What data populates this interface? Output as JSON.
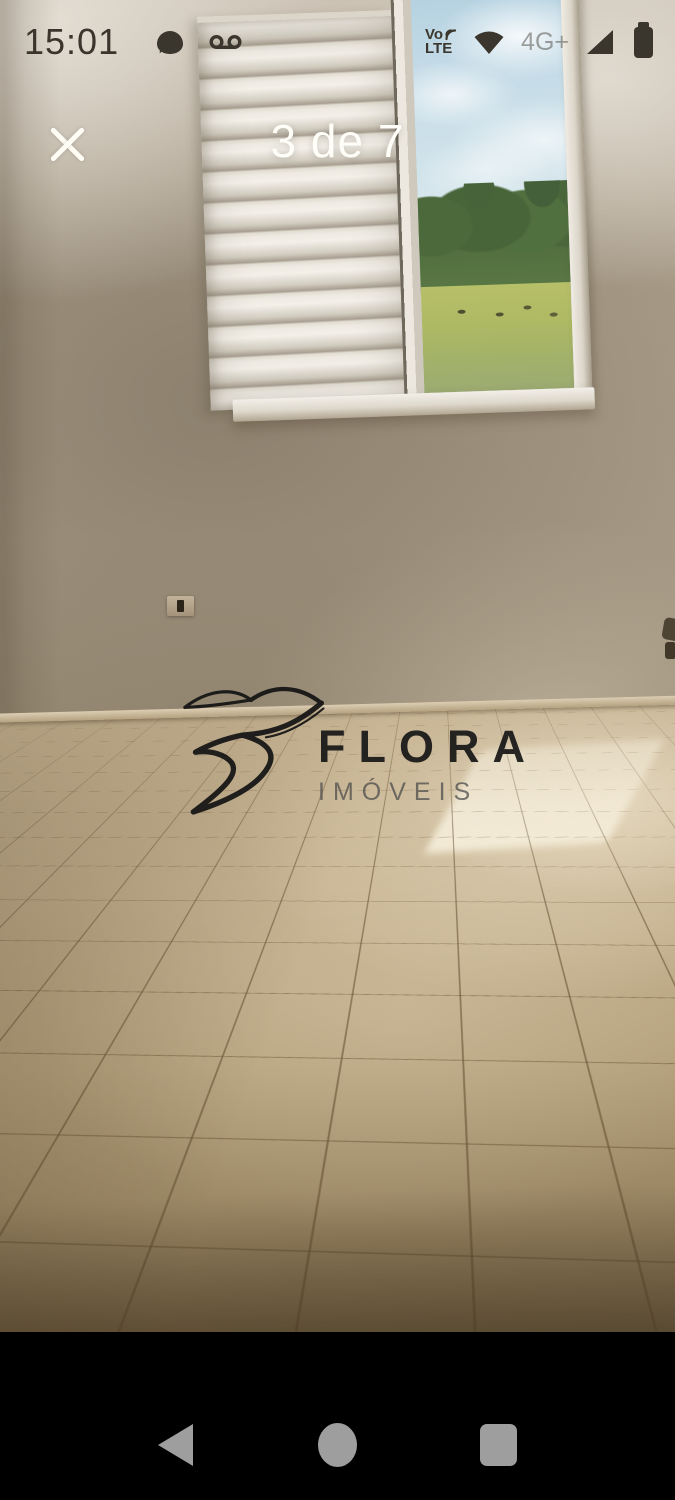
{
  "status_bar": {
    "time": "15:01",
    "volte": {
      "top": "Vo",
      "bottom": "LTE"
    },
    "network_badge": "4G+",
    "icons": [
      "chat-bubble-icon",
      "voicemail-icon",
      "volte-icon",
      "wifi-icon",
      "signal-strength-icon",
      "battery-icon"
    ]
  },
  "gallery_header": {
    "counter": "3 de 7",
    "close_icon": "close-icon"
  },
  "photo": {
    "watermark": {
      "title": "FLORA",
      "subtitle": "IMÓVEIS"
    }
  },
  "navigation_bar": {
    "icons": [
      "back-icon",
      "home-icon",
      "recents-icon"
    ]
  },
  "icon_shapes": {
    "close-icon": "white-x-cross",
    "back-icon": "left-triangle",
    "home-icon": "circle",
    "recents-icon": "rounded-square",
    "wifi-icon": "filled-fan",
    "signal-strength-icon": "right-triangle",
    "battery-icon": "rounded-rect-with-nub",
    "chat-bubble-icon": "filled-speech-bubble",
    "voicemail-icon": "two-circles-bar"
  },
  "colors": {
    "status_text": "#3a362d",
    "header_text": "#fffdf8",
    "nav_bar_bg": "#000000",
    "nav_icon": "#9e9e9e",
    "wall": "#a2967f",
    "floor_tile": "#c4b18f",
    "grout": "#665032",
    "sky": "#c4dbe7",
    "trees": "#4c693b",
    "field": "#aeb968",
    "sunpatch": "#faf3e0",
    "watermark_title": "#171717",
    "watermark_subtitle": "#4b4b4b"
  }
}
